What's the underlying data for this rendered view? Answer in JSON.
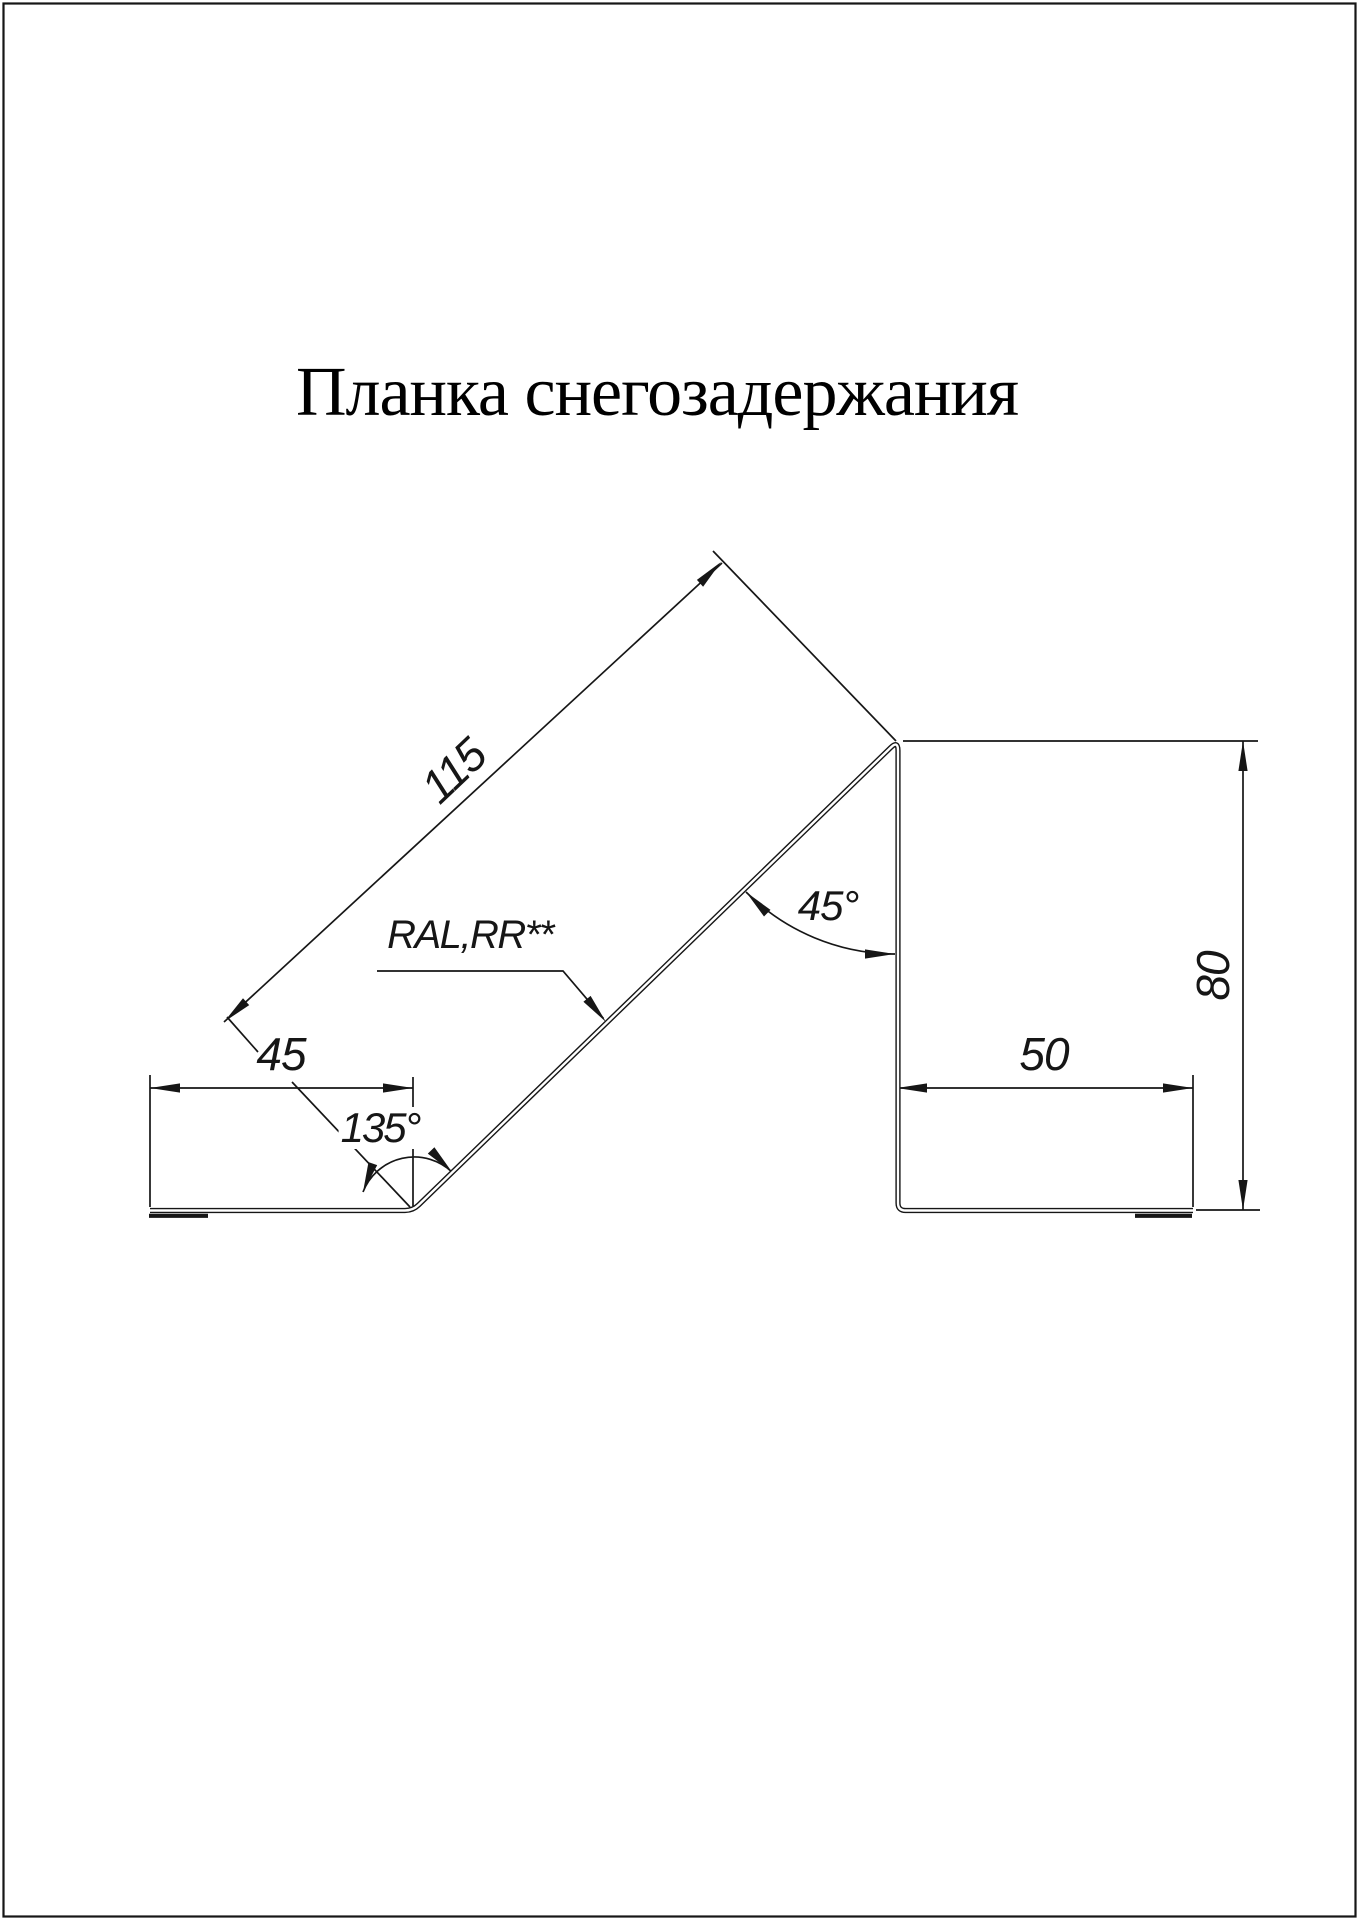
{
  "page": {
    "title": "Планка снегозадержания"
  },
  "dimensions": {
    "slope_length": "115",
    "left_flange_width": "45",
    "left_bend_angle": "135°",
    "right_bend_angle": "45°",
    "right_flange_width": "50",
    "vertical_height": "80"
  },
  "annotations": {
    "coating_label": "RAL,RR**"
  },
  "colors": {
    "ink": "#161616",
    "paper": "#ffffff"
  }
}
